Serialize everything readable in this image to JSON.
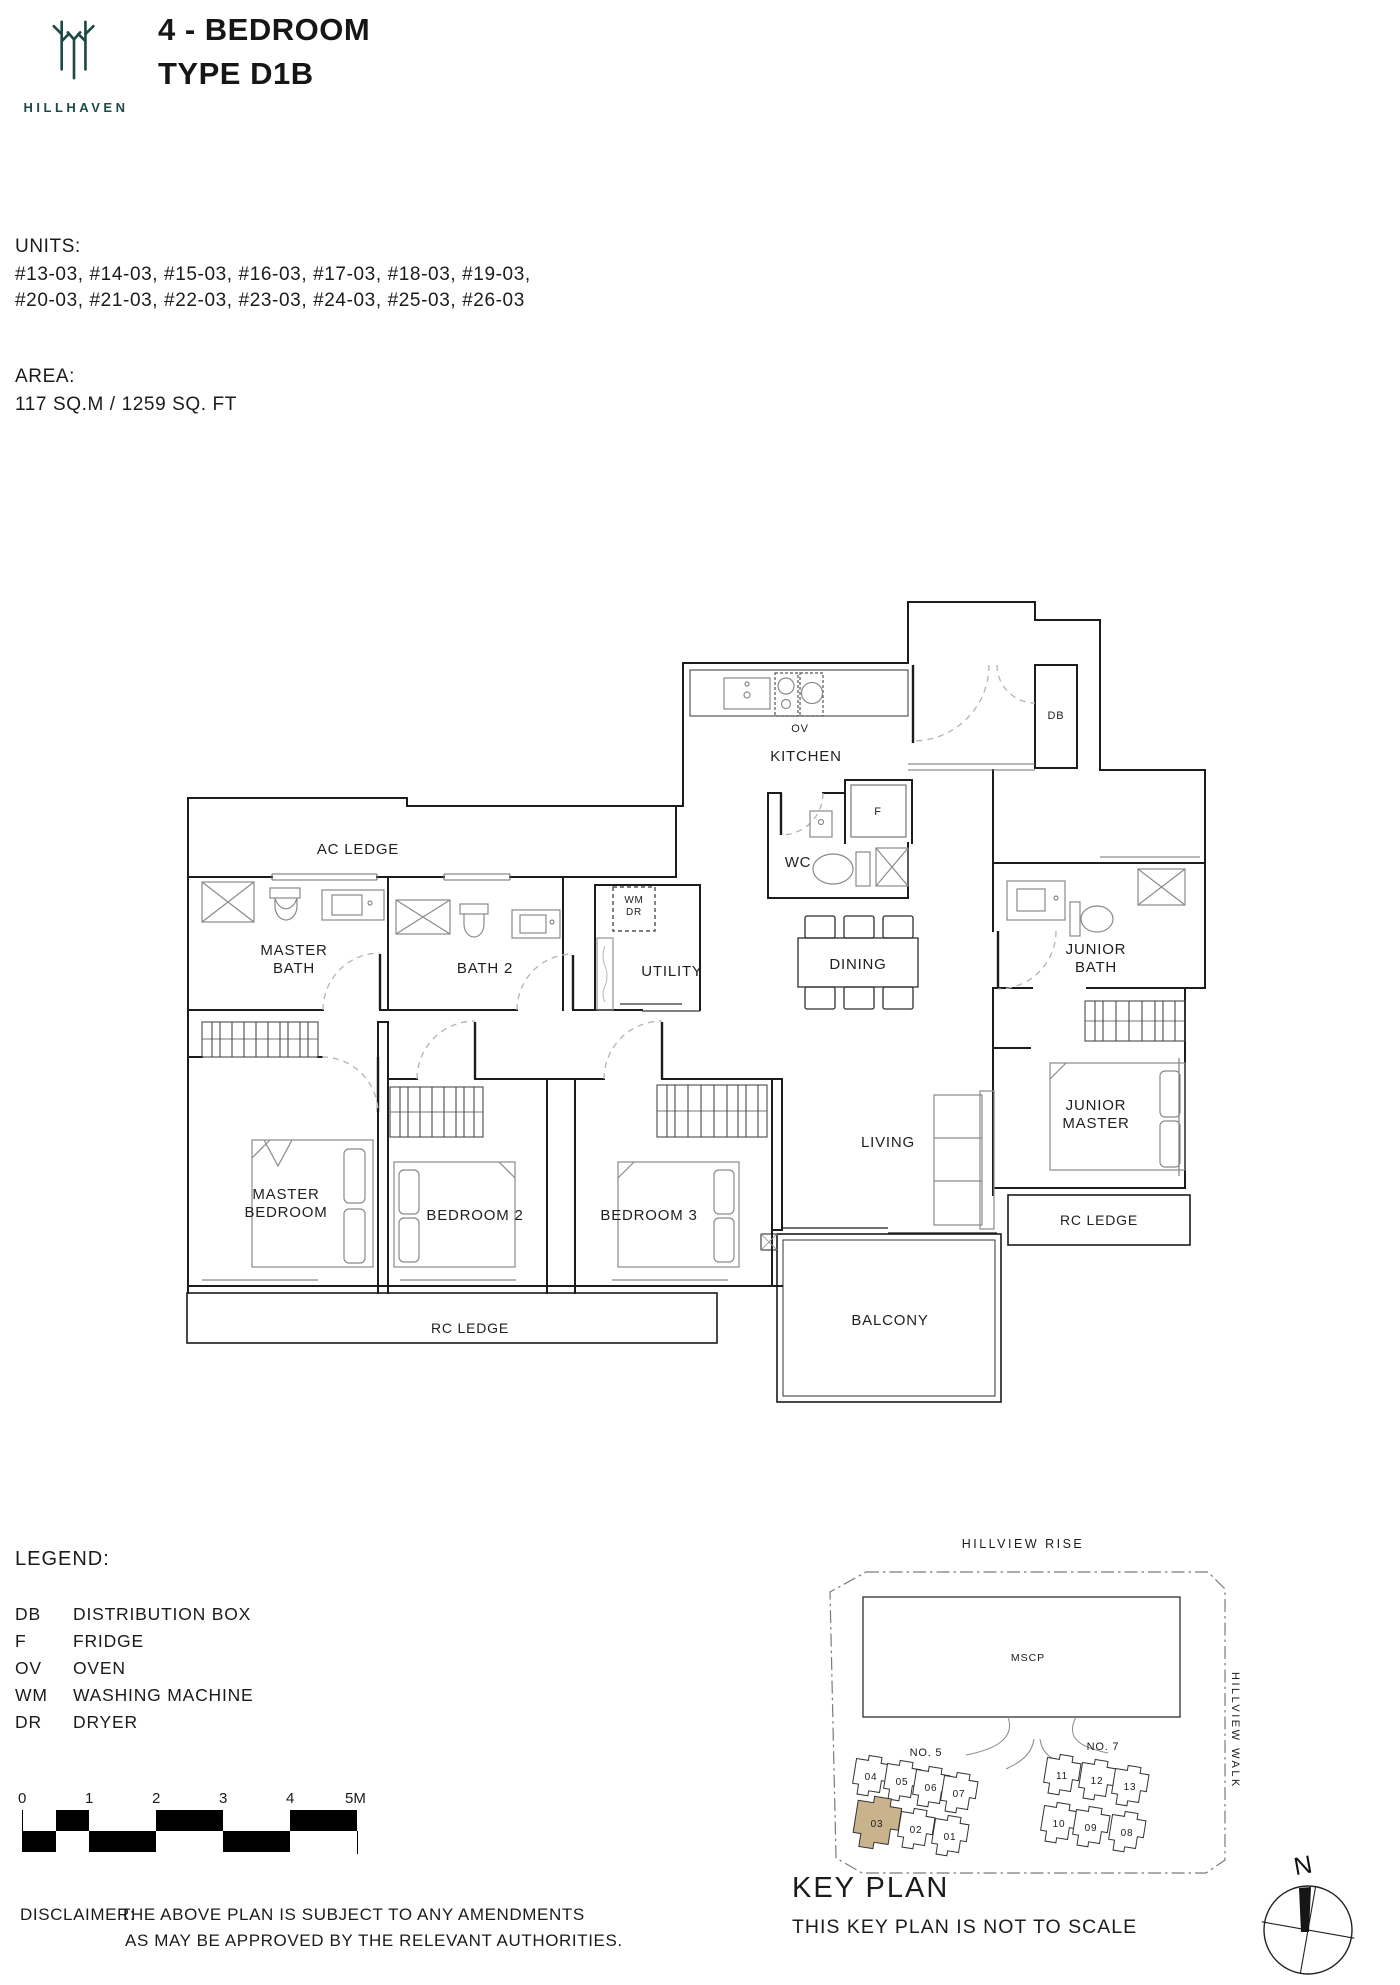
{
  "header": {
    "brand": "HILLHAVEN",
    "title_line1": "4 - BEDROOM",
    "title_line2": "TYPE D1B"
  },
  "units": {
    "label": "UNITS:",
    "line1": "#13-03, #14-03, #15-03, #16-03, #17-03, #18-03, #19-03,",
    "line2": "#20-03, #21-03, #22-03, #23-03, #24-03, #25-03, #26-03"
  },
  "area": {
    "label": "AREA:",
    "value": "117 SQ.M / 1259 SQ. FT"
  },
  "floor_plan": {
    "labels": [
      {
        "t": "AC LEDGE",
        "x": 186,
        "y": 256,
        "s": 15
      },
      {
        "t": "OV",
        "x": 628,
        "y": 134,
        "s": 11
      },
      {
        "t": "KITCHEN",
        "x": 634,
        "y": 163,
        "s": 15
      },
      {
        "t": "DB",
        "x": 884,
        "y": 121,
        "s": 11
      },
      {
        "t": "F",
        "x": 706,
        "y": 217,
        "s": 11
      },
      {
        "t": "WC",
        "x": 626,
        "y": 269,
        "s": 15
      },
      {
        "t": "DINING",
        "x": 686,
        "y": 371,
        "s": 15
      },
      {
        "t": "MASTER",
        "x": 122,
        "y": 357,
        "s": 15
      },
      {
        "t": "BATH",
        "x": 122,
        "y": 375,
        "s": 15
      },
      {
        "t": "BATH 2",
        "x": 313,
        "y": 375,
        "s": 15
      },
      {
        "t": "UTILITY",
        "x": 500,
        "y": 378,
        "s": 15
      },
      {
        "t": "WM",
        "x": 462,
        "y": 305,
        "s": 10
      },
      {
        "t": "DR",
        "x": 462,
        "y": 317,
        "s": 10
      },
      {
        "t": "JUNIOR",
        "x": 924,
        "y": 356,
        "s": 15
      },
      {
        "t": "BATH",
        "x": 924,
        "y": 374,
        "s": 15
      },
      {
        "t": "JUNIOR",
        "x": 924,
        "y": 512,
        "s": 15
      },
      {
        "t": "MASTER",
        "x": 924,
        "y": 530,
        "s": 15
      },
      {
        "t": "MASTER",
        "x": 114,
        "y": 601,
        "s": 15
      },
      {
        "t": "BEDROOM",
        "x": 114,
        "y": 619,
        "s": 15
      },
      {
        "t": "BEDROOM 2",
        "x": 303,
        "y": 622,
        "s": 15
      },
      {
        "t": "BEDROOM 3",
        "x": 477,
        "y": 622,
        "s": 15
      },
      {
        "t": "LIVING",
        "x": 716,
        "y": 549,
        "s": 15
      },
      {
        "t": "BALCONY",
        "x": 718,
        "y": 727,
        "s": 15
      },
      {
        "t": "RC LEDGE",
        "x": 298,
        "y": 735,
        "s": 14
      },
      {
        "t": "RC LEDGE",
        "x": 927,
        "y": 627,
        "s": 14
      }
    ]
  },
  "legend": {
    "label": "LEGEND:",
    "items": [
      {
        "abbr": "DB",
        "desc": "DISTRIBUTION BOX"
      },
      {
        "abbr": "F",
        "desc": "FRIDGE"
      },
      {
        "abbr": "OV",
        "desc": "OVEN"
      },
      {
        "abbr": "WM",
        "desc": "WASHING MACHINE"
      },
      {
        "abbr": "DR",
        "desc": "DRYER"
      }
    ]
  },
  "scale_bar": {
    "labels": [
      "0",
      "1",
      "2",
      "3",
      "4",
      "5M"
    ]
  },
  "disclaimer": {
    "label": "DISCLAIMER:",
    "line1": "THE ABOVE PLAN IS SUBJECT TO ANY AMENDMENTS",
    "line2": "AS MAY BE APPROVED BY THE RELEVANT AUTHORITIES."
  },
  "key_plan": {
    "road_top": "HILLVIEW RISE",
    "road_right": "HILLVIEW WALK",
    "mscp": "MSCP",
    "block_labels": [
      {
        "t": "NO. 5",
        "x": 148,
        "y": 264
      },
      {
        "t": "NO. 7",
        "x": 325,
        "y": 258
      }
    ],
    "units": [
      {
        "id": "04",
        "x": 93,
        "y": 284,
        "hl": false
      },
      {
        "id": "05",
        "x": 124,
        "y": 289,
        "hl": false
      },
      {
        "id": "06",
        "x": 153,
        "y": 295,
        "hl": false
      },
      {
        "id": "07",
        "x": 181,
        "y": 301,
        "hl": false
      },
      {
        "id": "03",
        "x": 99,
        "y": 331,
        "hl": true
      },
      {
        "id": "02",
        "x": 138,
        "y": 337,
        "hl": false
      },
      {
        "id": "01",
        "x": 172,
        "y": 344,
        "hl": false
      },
      {
        "id": "11",
        "x": 284,
        "y": 283,
        "hl": false
      },
      {
        "id": "12",
        "x": 319,
        "y": 288,
        "hl": false
      },
      {
        "id": "13",
        "x": 352,
        "y": 294,
        "hl": false
      },
      {
        "id": "10",
        "x": 281,
        "y": 331,
        "hl": false
      },
      {
        "id": "09",
        "x": 313,
        "y": 335,
        "hl": false
      },
      {
        "id": "08",
        "x": 349,
        "y": 340,
        "hl": false
      }
    ],
    "highlight_color": "#c9b38c",
    "title": "KEY PLAN",
    "subtitle": "THIS KEY PLAN IS NOT TO SCALE"
  },
  "compass": {
    "label": "N"
  },
  "colors": {
    "brand_teal": "#1d4a47",
    "wall": "#1c1c1c",
    "fixture_gray": "#8a8a8a",
    "highlight": "#c9b38c"
  }
}
